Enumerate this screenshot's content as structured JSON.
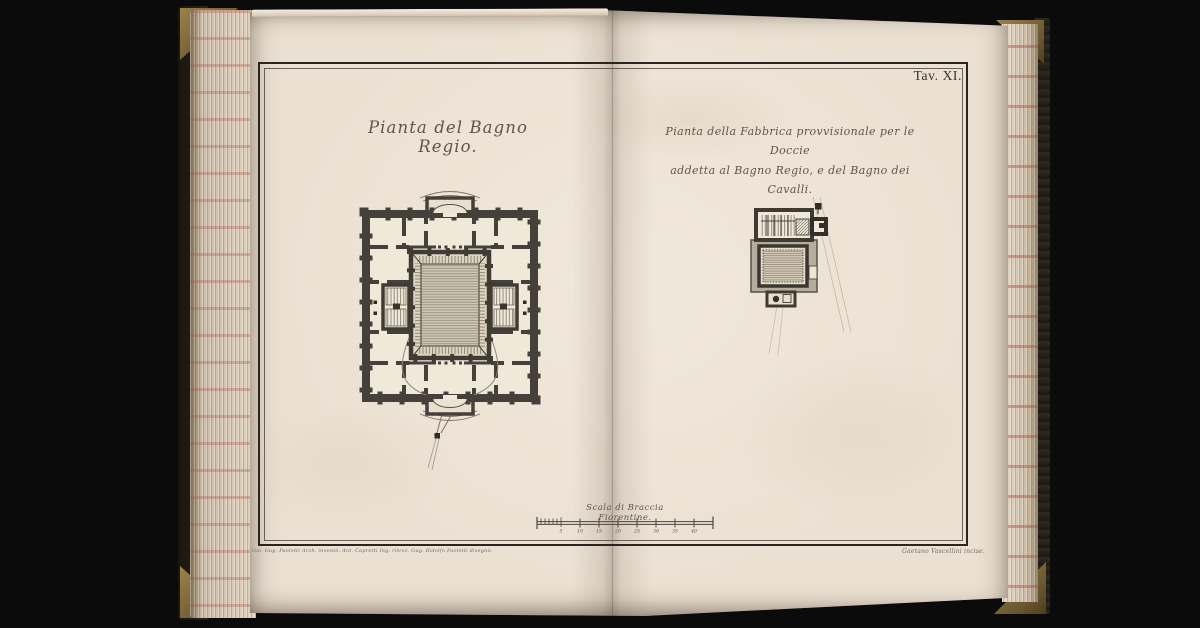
{
  "page": {
    "background": "#0b0b0c"
  },
  "book": {
    "colors": {
      "paper": "#ebe1d3",
      "paper_light": "#f0e8d9",
      "cover": "#241f15",
      "gilt_corner": "#8a713d",
      "fore_edge": "#cdbda8",
      "marble_red": "#a34f42"
    }
  },
  "plate": {
    "number": "Tav. XI.",
    "frame_color": "#29251f",
    "ink_color": "#5e564a",
    "titles": {
      "left": "Pianta del Bagno Regio.",
      "right_line1": "Pianta della Fabbrica provvisionale per le Doccie",
      "right_line2": "addetta al Bagno Regio, e del Bagno dei Cavalli."
    },
    "scale": {
      "label": "Scala di Braccia Fiorentine.",
      "ticks": [
        "5",
        "10",
        "15",
        "20",
        "25",
        "30",
        "35",
        "40"
      ]
    },
    "credits": {
      "left": "Gio. Gug. Paoletti Arch. inventò. Ant. Capretti Ing. rilevò. Gug. Ridolfo Paoletti disegnò.",
      "right": "Gaetano Vascellini incise."
    }
  }
}
